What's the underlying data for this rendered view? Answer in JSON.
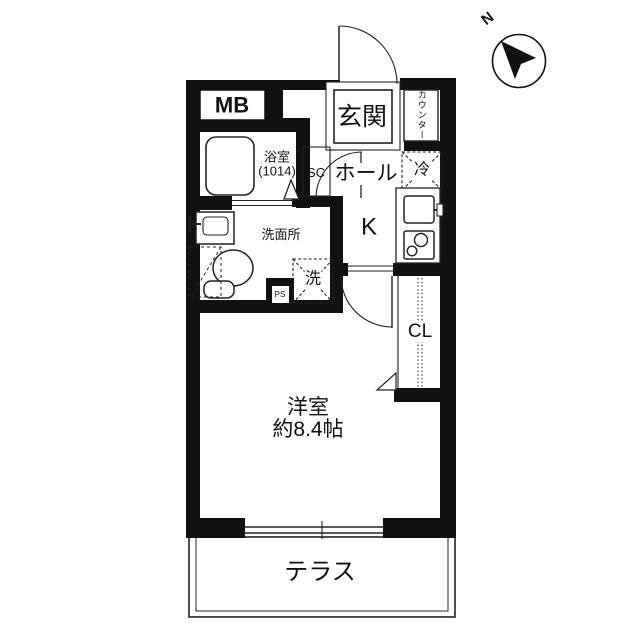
{
  "plan_title": "1K apartment floor plan",
  "compass": {
    "north_label": "N"
  },
  "rooms": {
    "meter_box": "MB",
    "entrance": "玄関",
    "counter": "カウンター",
    "bathroom_name": "浴室",
    "bathroom_size": "(1014)",
    "shoe_closet": "SC",
    "hall": "ホール",
    "refrigerator": "冷",
    "kitchen": "K",
    "washroom": "洗面所",
    "washer": "洗",
    "pipe_space": "PS",
    "closet": "CL",
    "main_room_name": "洋室",
    "main_room_area": "約8.4帖",
    "terrace": "テラス"
  },
  "colors": {
    "wall": "#111111",
    "line": "#222222",
    "background": "#ffffff"
  }
}
